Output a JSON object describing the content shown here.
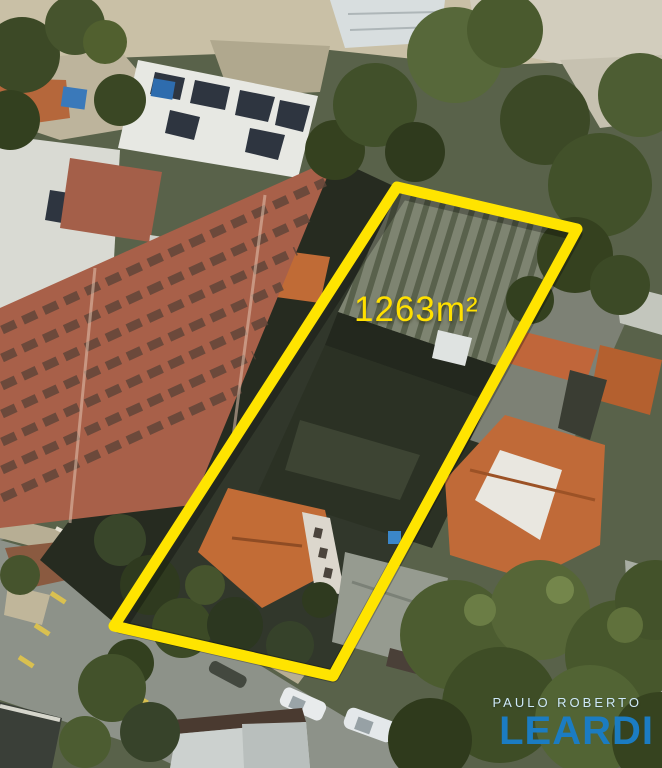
{
  "overlay": {
    "area_label": "1263m²"
  },
  "branding": {
    "line1": "PAULO ROBERTO",
    "line2": "LEARDI"
  },
  "colors": {
    "highlight_yellow": "#FFE400",
    "brand_blue": "#1B7CC2",
    "brand_light_blue": "#CFE9F8"
  }
}
